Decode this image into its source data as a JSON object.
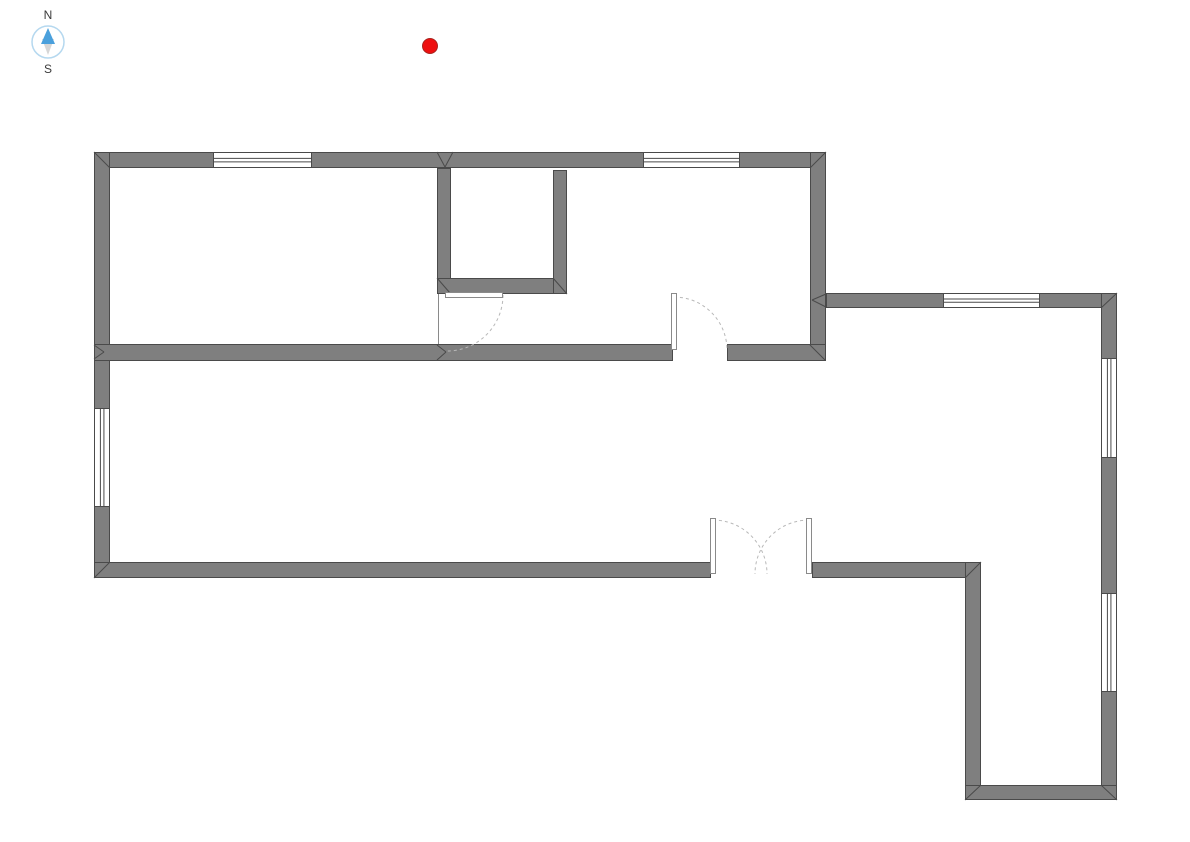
{
  "canvas": {
    "width": 1190,
    "height": 842,
    "background": "#ffffff"
  },
  "compass": {
    "north_label": "N",
    "south_label": "S",
    "ring_color": "#b5d8ef",
    "north_arrow_color": "#4aa0dc",
    "south_arrow_color": "#d6d6d6",
    "label_color": "#3a3a3a",
    "radius": 16
  },
  "marker": {
    "x": 430,
    "y": 46,
    "radius": 8,
    "fill": "#ee0f0f",
    "stroke": "#a8251f"
  },
  "floorplan": {
    "colors": {
      "wall_fill": "#7f7f7f",
      "wall_stroke": "#4a4a4a",
      "door_arc": "#b8b8b8",
      "door_leaf_stroke": "#8a8a8a",
      "opening_fill": "#ffffff"
    },
    "walls": [
      {
        "name": "wall-exterior-top",
        "x": 94,
        "y": 152,
        "w": 732,
        "h": 16
      },
      {
        "name": "wall-exterior-left",
        "x": 94,
        "y": 152,
        "w": 16,
        "h": 426
      },
      {
        "name": "wall-top-section-right",
        "x": 810,
        "y": 152,
        "w": 16,
        "h": 209
      },
      {
        "name": "wall-interior-middle",
        "x": 94,
        "y": 344,
        "w": 732,
        "h": 17
      },
      {
        "name": "wall-interior-vertical",
        "x": 437,
        "y": 168,
        "w": 14,
        "h": 126
      },
      {
        "name": "wall-closet-bottom",
        "x": 437,
        "y": 278,
        "w": 130,
        "h": 16
      },
      {
        "name": "wall-closet-right",
        "x": 553,
        "y": 170,
        "w": 14,
        "h": 124
      },
      {
        "name": "wall-extension-top",
        "x": 826,
        "y": 293,
        "w": 291,
        "h": 15
      },
      {
        "name": "wall-exterior-right",
        "x": 1101,
        "y": 293,
        "w": 16,
        "h": 507
      },
      {
        "name": "wall-exterior-bottom-main",
        "x": 94,
        "y": 562,
        "w": 887,
        "h": 16
      },
      {
        "name": "wall-step-vertical",
        "x": 965,
        "y": 562,
        "w": 16,
        "h": 238
      },
      {
        "name": "wall-exterior-bottom-right",
        "x": 965,
        "y": 785,
        "w": 152,
        "h": 15
      }
    ],
    "windows": [
      {
        "name": "window-top-left",
        "x": 213,
        "y": 152,
        "w": 99,
        "h": 16,
        "orientation": "horizontal"
      },
      {
        "name": "window-top-right",
        "x": 643,
        "y": 152,
        "w": 97,
        "h": 16,
        "orientation": "horizontal"
      },
      {
        "name": "window-left-wall",
        "x": 94,
        "y": 408,
        "w": 16,
        "h": 99,
        "orientation": "vertical"
      },
      {
        "name": "window-extension-top",
        "x": 943,
        "y": 293,
        "w": 97,
        "h": 15,
        "orientation": "horizontal"
      },
      {
        "name": "window-right-upper",
        "x": 1101,
        "y": 358,
        "w": 16,
        "h": 100,
        "orientation": "vertical"
      },
      {
        "name": "window-right-lower",
        "x": 1101,
        "y": 593,
        "w": 16,
        "h": 99,
        "orientation": "vertical"
      }
    ],
    "door_openings": [
      {
        "name": "doorway-bedroom",
        "x": 672,
        "y": 344,
        "w": 55,
        "h": 17
      },
      {
        "name": "doorway-entrance",
        "x": 710,
        "y": 562,
        "w": 102,
        "h": 16
      }
    ],
    "door_leaves": [
      {
        "name": "door-leaf-closet-room",
        "x": 445,
        "y": 292,
        "w": 58,
        "h": 6
      },
      {
        "name": "door-leaf-bedroom",
        "x": 671,
        "y": 293,
        "w": 6,
        "h": 57
      },
      {
        "name": "door-leaf-entrance-left",
        "x": 710,
        "y": 518,
        "w": 6,
        "h": 56
      },
      {
        "name": "door-leaf-entrance-right",
        "x": 806,
        "y": 518,
        "w": 6,
        "h": 56
      }
    ],
    "door_arcs": [
      {
        "name": "door-arc-closet-room",
        "d": "M 503 295 A 56 56 0 0 1 447 351"
      },
      {
        "name": "door-arc-bedroom",
        "d": "M 674 297 A 53 53 0 0 1 727 350"
      },
      {
        "name": "door-arc-entrance-left",
        "d": "M 713 520 A 54 54 0 0 1 767 574"
      },
      {
        "name": "door-arc-entrance-right",
        "d": "M 809 520 A 54 54 0 0 0 755 574"
      }
    ],
    "edge_lines": [
      {
        "name": "opening-edge-left-room",
        "x1": 438,
        "y1": 294,
        "x2": 438,
        "y2": 344
      }
    ],
    "corner_marks": [
      [
        94,
        152,
        110,
        168
      ],
      [
        826,
        152,
        810,
        168
      ],
      [
        94,
        578,
        110,
        562
      ],
      [
        94,
        345,
        104,
        352
      ],
      [
        94,
        359,
        104,
        352
      ],
      [
        437,
        152,
        445,
        167
      ],
      [
        453,
        152,
        445,
        167
      ],
      [
        437,
        345,
        446,
        352
      ],
      [
        437,
        360,
        446,
        352
      ],
      [
        826,
        294,
        812,
        300
      ],
      [
        826,
        307,
        812,
        300
      ],
      [
        810,
        345,
        825,
        360
      ],
      [
        1101,
        308,
        1117,
        293
      ],
      [
        965,
        578,
        981,
        562
      ],
      [
        965,
        800,
        981,
        785
      ],
      [
        1101,
        785,
        1117,
        800
      ],
      [
        553,
        278,
        567,
        294
      ],
      [
        437,
        278,
        450,
        293
      ]
    ]
  }
}
